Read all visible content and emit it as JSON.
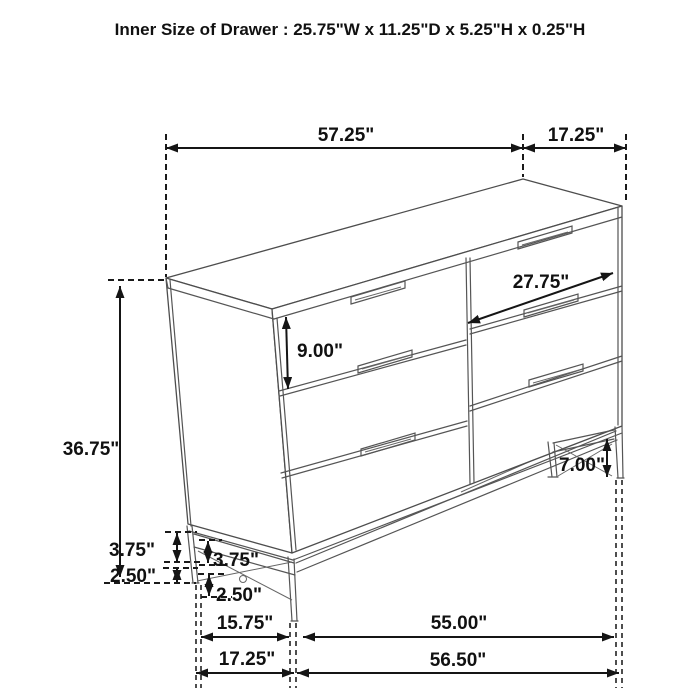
{
  "title": "Inner Size of Drawer : 25.75\"W x 11.25\"D x 5.25\"H x 0.25\"H",
  "diagram": {
    "type": "furniture-dimension-diagram",
    "subject": "six-drawer dresser with metal base frame",
    "dimensions": {
      "top_width": "57.25\"",
      "top_depth": "17.25\"",
      "overall_height": "36.75\"",
      "drawer_front_width": "27.75\"",
      "top_drawer_height": "9.00\"",
      "right_leg_height": "7.00\"",
      "left_frame_height_outer": "3.75\"",
      "left_frame_height_inner": "3.75\"",
      "left_leg_bottom_outer": "2.50\"",
      "left_leg_bottom_inner": "2.50\"",
      "base_depth_inner": "15.75\"",
      "base_depth_outer": "17.25\"",
      "base_width_inner": "55.00\"",
      "base_width_outer": "56.50\""
    }
  }
}
